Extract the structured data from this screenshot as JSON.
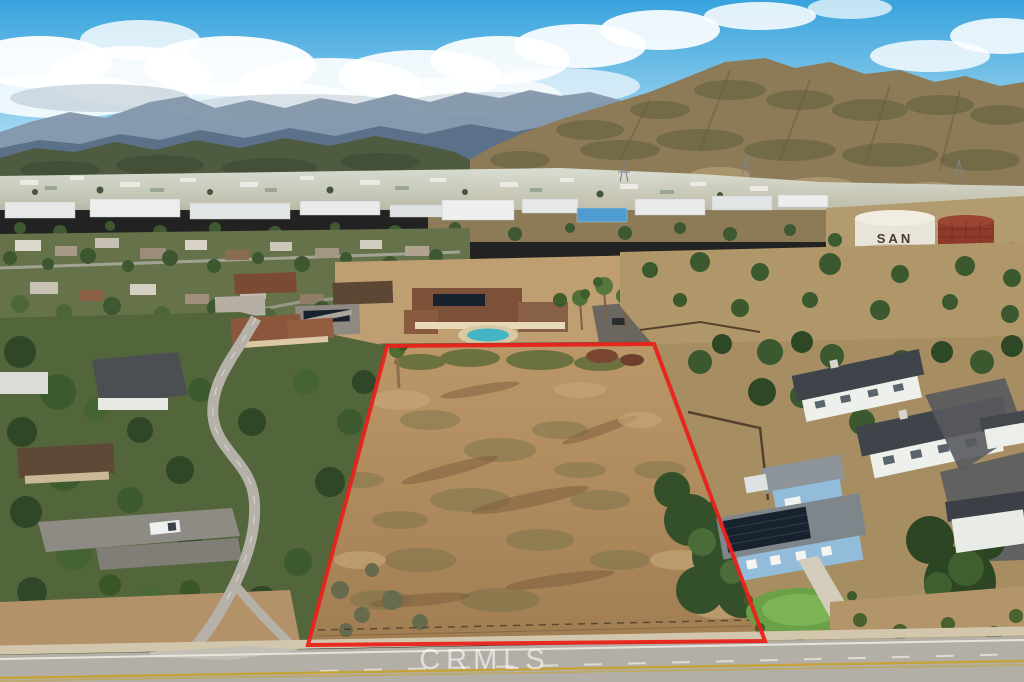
{
  "image": {
    "width": 1024,
    "height": 682,
    "kind": "aerial-real-estate-photo"
  },
  "watermark": {
    "text": "CRMLS"
  },
  "water_tank": {
    "label": "SAN"
  },
  "boundary": {
    "points": "387,346 654,344 765,641 308,645"
  },
  "palette": {
    "boundary_red": "#e8231a",
    "sky_top": "#38a3dd",
    "sky_bottom": "#c3e7f5",
    "far_mountain": "#8497ab",
    "mid_mountain": "#5b7089",
    "left_foothill": "#4f5b40",
    "right_foothill": "#8d7a57",
    "lot_dirt": "#b38e62",
    "scrub_green": "#6d6f46",
    "tree_green": "#3c5530",
    "road_gray": "#b3afa7",
    "sidewalk_tan": "#d2c6ad",
    "house_white": "#eef0ec",
    "house_blue": "#92bcd9",
    "roof_charcoal": "#3f444a",
    "roof_tile_brown": "#83503a",
    "solar_panel": "#18222e",
    "pool_teal": "#45b5c6",
    "lane_yellow": "#c9a227",
    "watermark_white": "rgba(255,255,255,0.6)",
    "tank_label_brown": "#4a3a30"
  }
}
